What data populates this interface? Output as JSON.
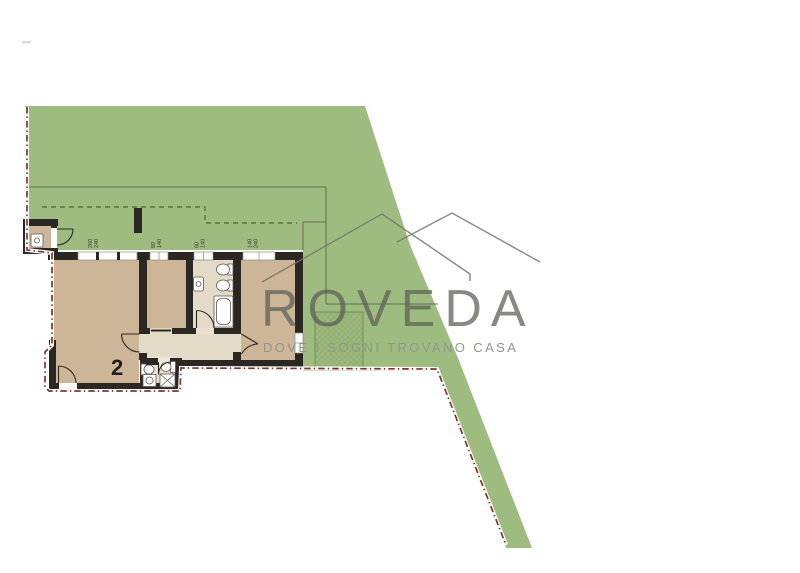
{
  "watermark": {
    "brand": "ROVEDA",
    "tagline": "DOVE I SOGNI TROVANO CASA"
  },
  "floor_plan": {
    "unit_number": "2",
    "windows": [
      {
        "w": "260",
        "h": "240"
      },
      {
        "w": "80",
        "h": "140"
      },
      {
        "w": "80",
        "h": "140"
      },
      {
        "w": "140",
        "h": "240"
      }
    ]
  },
  "colors": {
    "garden_green": "#9fbc80",
    "room_tan": "#cdb598",
    "hallway_light": "#e4dac8",
    "wall_dark": "#2b2823",
    "boundary_red": "#7c352b",
    "garden_line_green": "#5a7144"
  }
}
